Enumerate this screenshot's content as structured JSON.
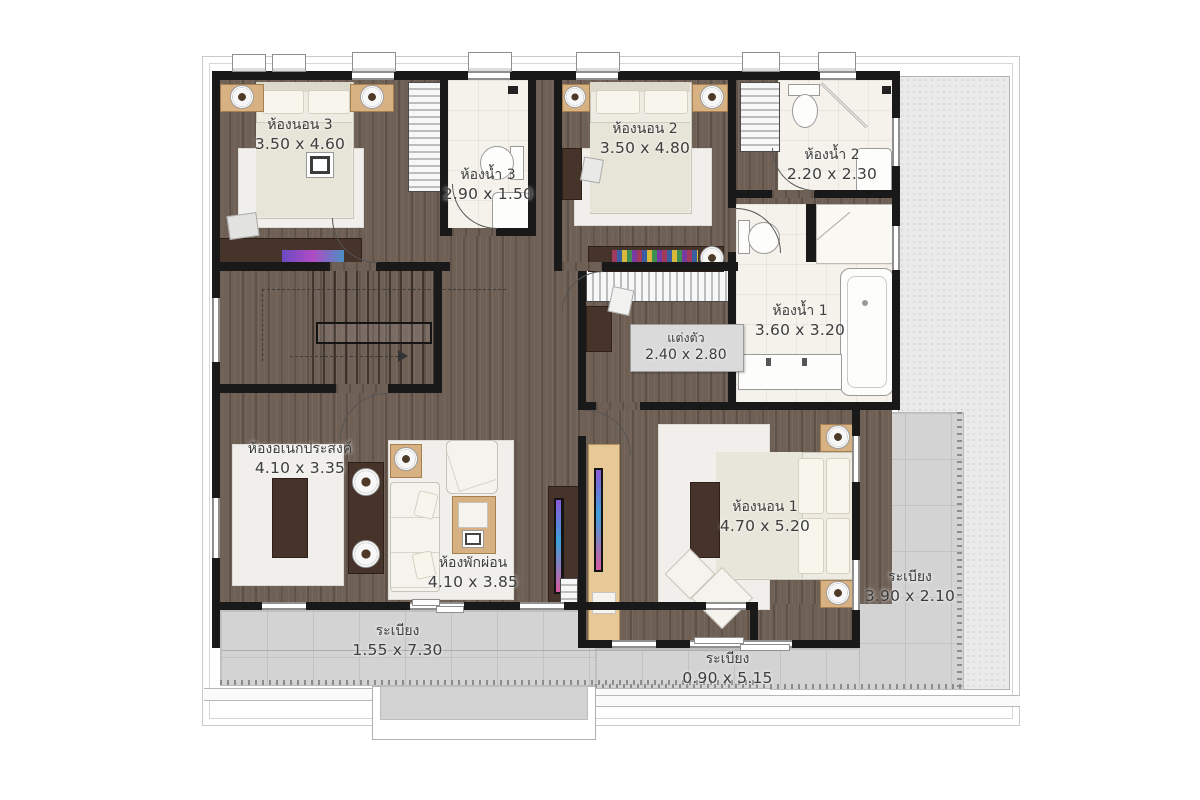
{
  "plan_type": "second-floor house plan",
  "rooms": [
    {
      "id": "bedroom-3",
      "name": "ห้องนอน 3",
      "dim": "3.50 x 4.60"
    },
    {
      "id": "bathroom-3",
      "name": "ห้องน้ำ 3",
      "dim": "2.90 x 1.50"
    },
    {
      "id": "bedroom-2",
      "name": "ห้องนอน 2",
      "dim": "3.50 x 4.80"
    },
    {
      "id": "bathroom-2",
      "name": "ห้องน้ำ 2",
      "dim": "2.20 x 2.30"
    },
    {
      "id": "bathroom-1",
      "name": "ห้องน้ำ 1",
      "dim": "3.60 x 3.20"
    },
    {
      "id": "dressing",
      "name": "แต่งตัว",
      "dim": "2.40 x 2.80"
    },
    {
      "id": "multipurpose-room",
      "name": "ห้องอเนกประสงค์",
      "dim": "4.10 x 3.35"
    },
    {
      "id": "living-room",
      "name": "ห้องพักผ่อน",
      "dim": "4.10 x 3.85"
    },
    {
      "id": "bedroom-1",
      "name": "ห้องนอน 1",
      "dim": "4.70 x 5.20"
    },
    {
      "id": "balcony-right",
      "name": "ระเบียง",
      "dim": "3.90 x 2.10"
    },
    {
      "id": "balcony-bottom-left",
      "name": "ระเบียง",
      "dim": "1.55 x 7.30"
    },
    {
      "id": "balcony-bottom-center",
      "name": "ระเบียง",
      "dim": "0.90 x 5.15"
    }
  ],
  "colors": {
    "wall": "#191919",
    "wood_floor": "#6f6055",
    "tile_floor": "#f4f2ea",
    "balcony_floor": "#d3d3d3",
    "roof": "#eaeaea",
    "label_text": "#3d3d3d"
  }
}
